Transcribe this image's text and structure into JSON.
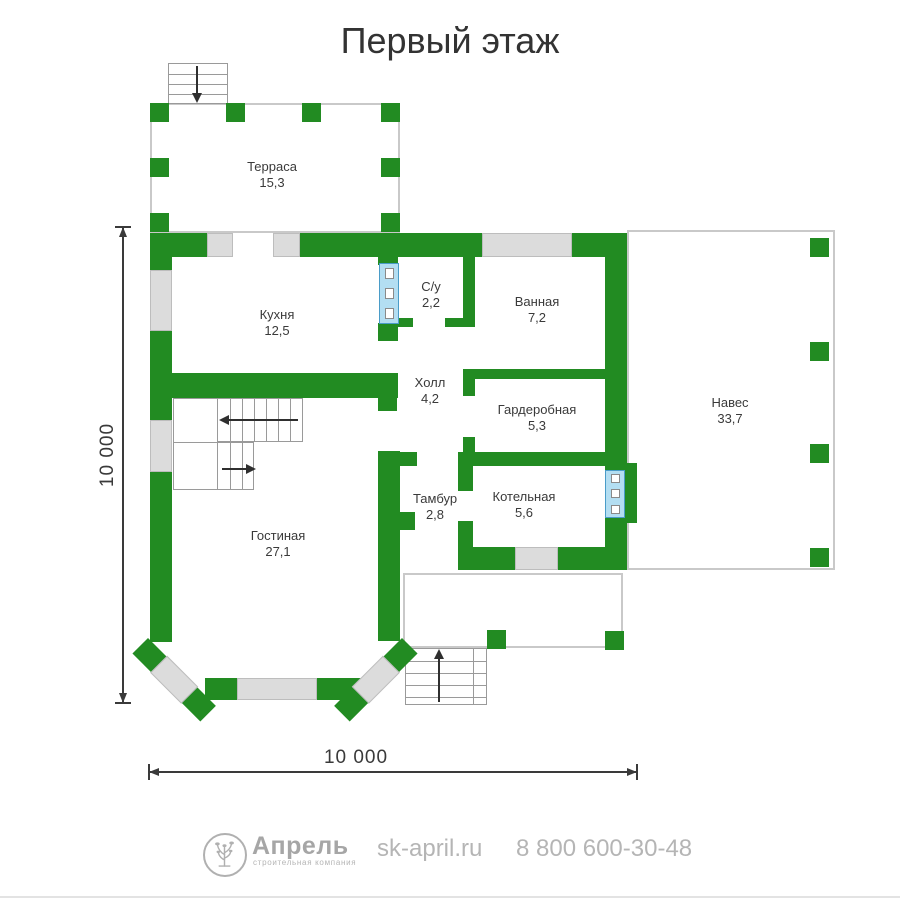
{
  "title": "Первый этаж",
  "colors": {
    "wall_green": "#228B22",
    "window_gray": "#dcdcdc",
    "glass_blue": "#b3def2",
    "outline_gray": "#c9c9c9",
    "text_dark": "#3a3a3a"
  },
  "rooms": {
    "terrace": {
      "name": "Терраса",
      "area": "15,3"
    },
    "kitchen": {
      "name": "Кухня",
      "area": "12,5"
    },
    "wc": {
      "name": "С/у",
      "area": "2,2"
    },
    "bathroom": {
      "name": "Ванная",
      "area": "7,2"
    },
    "hall": {
      "name": "Холл",
      "area": "4,2"
    },
    "wardrobe": {
      "name": "Гардеробная",
      "area": "5,3"
    },
    "vestibule": {
      "name": "Тамбур",
      "area": "2,8"
    },
    "boiler": {
      "name": "Котельная",
      "area": "5,6"
    },
    "living": {
      "name": "Гостиная",
      "area": "27,1"
    },
    "canopy": {
      "name": "Навес",
      "area": "33,7"
    }
  },
  "dimensions": {
    "vertical": "10 000",
    "horizontal": "10 000"
  },
  "footer": {
    "brand": "Апрель",
    "tagline": "строительная компания",
    "website": "sk-april.ru",
    "phone": "8 800 600-30-48"
  }
}
